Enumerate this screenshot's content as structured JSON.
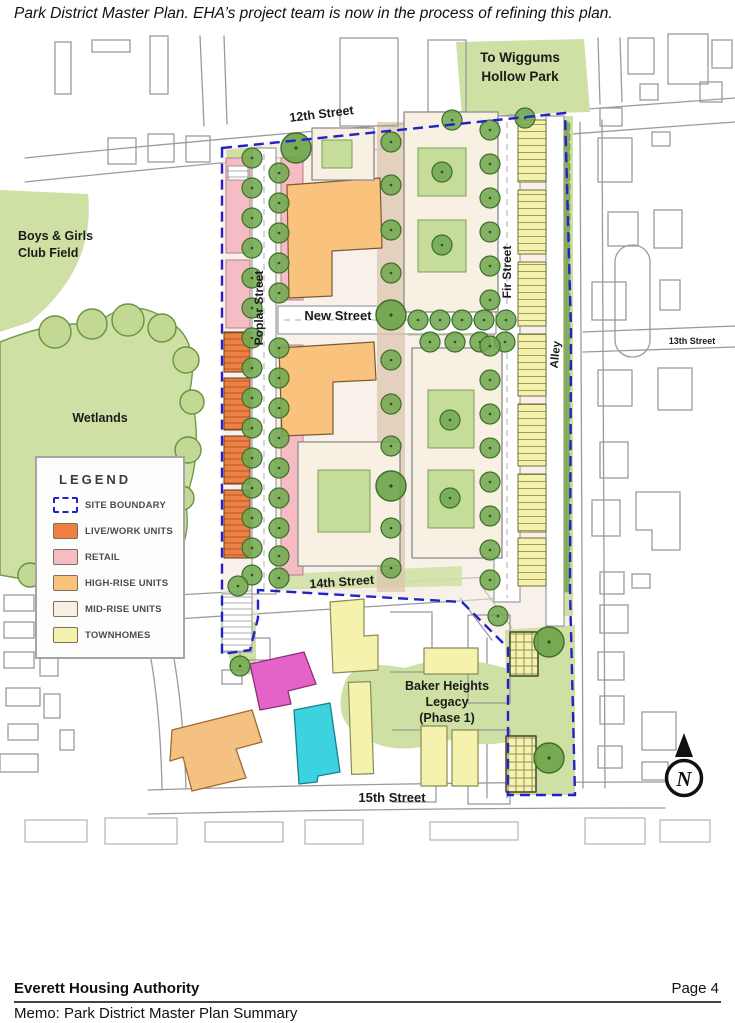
{
  "page": {
    "caption": "Park District Master Plan. EHA’s project team is now in the process of refining this plan.",
    "footer": {
      "org": "Everett Housing Authority",
      "page_number": "Page 4",
      "memo": "Memo: Park District Master Plan Summary"
    }
  },
  "map": {
    "labels": {
      "wiggums_line1": "To Wiggums",
      "wiggums_line2": "Hollow Park",
      "street_12th": "12th Street",
      "street_13th": "13th Street",
      "boys_girls_line1": "Boys & Girls",
      "boys_girls_line2": "Club Field",
      "wetlands": "Wetlands",
      "poplar_street": "Poplar Street",
      "new_street": "New Street",
      "fir_street": "Fir Street",
      "alley": "Alley",
      "street_14th": "14th Street",
      "baker_line1": "Baker Heights",
      "baker_line2": "Legacy",
      "baker_line3": "(Phase 1)",
      "street_15th": "15th Street",
      "north_letter": "N"
    },
    "legend": {
      "title": "LEGEND",
      "items": [
        {
          "label": "SITE BOUNDARY",
          "swatch": "dashed-boundary",
          "color": "#2222c8"
        },
        {
          "label": "LIVE/WORK UNITS",
          "swatch": "fill",
          "color": "#ef8044"
        },
        {
          "label": "RETAIL",
          "swatch": "fill",
          "color": "#f6bcc3"
        },
        {
          "label": "HIGH-RISE UNITS",
          "swatch": "fill",
          "color": "#f9c37d"
        },
        {
          "label": "MID-RISE UNITS",
          "swatch": "fill",
          "color": "#f8f1e3"
        },
        {
          "label": "TOWNHOMES",
          "swatch": "fill",
          "color": "#f5f2ae"
        }
      ]
    },
    "colors": {
      "boundary_blue": "#2222c8",
      "park_green": "#cfe0a4",
      "tree_green": "#72a950",
      "magenta_building": "#e563c9",
      "cyan_building": "#3cd2e0",
      "peach_building": "#f4c183"
    }
  }
}
